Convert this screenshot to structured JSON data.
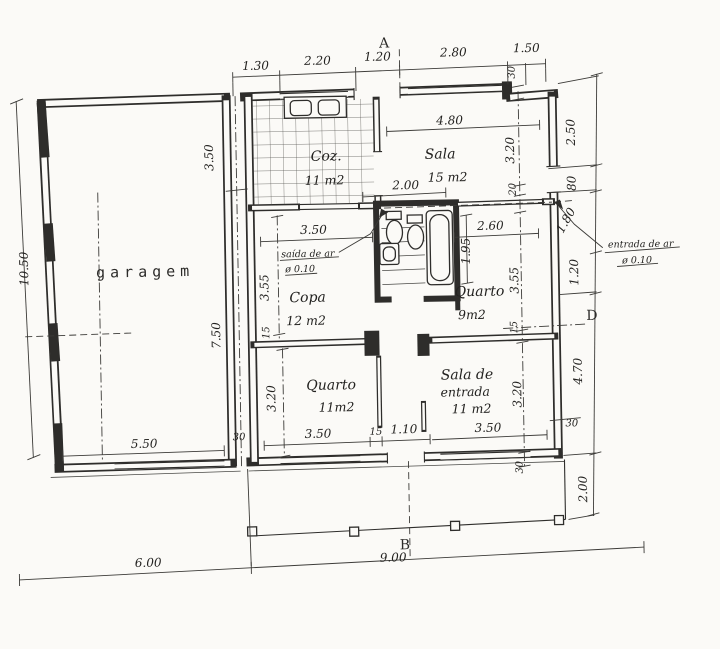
{
  "plan": {
    "title": "house floor plan",
    "markers": {
      "a": "A",
      "b": "B",
      "d": "D"
    },
    "rooms": {
      "garage": {
        "label": "garagem"
      },
      "kitchen": {
        "label": "Coz.",
        "area": "11 m2"
      },
      "sala": {
        "label": "Sala",
        "area": "15 m2"
      },
      "copa": {
        "label": "Copa",
        "area": "12 m2"
      },
      "quarto9": {
        "label": "Quarto",
        "area": "9m2"
      },
      "quarto11": {
        "label": "Quarto",
        "area": "11m2"
      },
      "entry": {
        "label1": "Sala de",
        "label2": "entrada",
        "area": "11 m2"
      }
    },
    "vents": {
      "exit": {
        "line1": "saída de ar",
        "line2": "ø 0.10"
      },
      "intake": {
        "line1": "entrada de ar",
        "line2": "ø 0.10"
      }
    },
    "dims": {
      "top": [
        "1.30",
        "2.20",
        "1.20",
        "2.80",
        "1.50"
      ],
      "left": "10.50",
      "garage_v": [
        "3.50",
        "7.50"
      ],
      "garage_b": [
        "5.50",
        "30"
      ],
      "bottom": [
        "6.00",
        "9.00"
      ],
      "right_outer": [
        "2.50",
        "80",
        "1.80",
        "1.20",
        "4.70",
        "2.00"
      ],
      "right_step": "30",
      "right_inner": [
        "30",
        "3.20",
        "20",
        "3.55",
        "15",
        "3.20",
        "30"
      ],
      "sala_w": "4.80",
      "sala_open": "2.00",
      "copa_w": "3.50",
      "quarto9_w": "2.60",
      "bath_l": "1.95",
      "copa_h": "3.55",
      "copa_wall": "15",
      "quarto11_h": "3.20",
      "quarto11_w": "3.50",
      "hall_wall": "15",
      "hall_w": "1.10",
      "entry_w": "3.50"
    },
    "colors": {
      "ink": "#2e2d2b",
      "paper": "#fbfaf7"
    }
  }
}
